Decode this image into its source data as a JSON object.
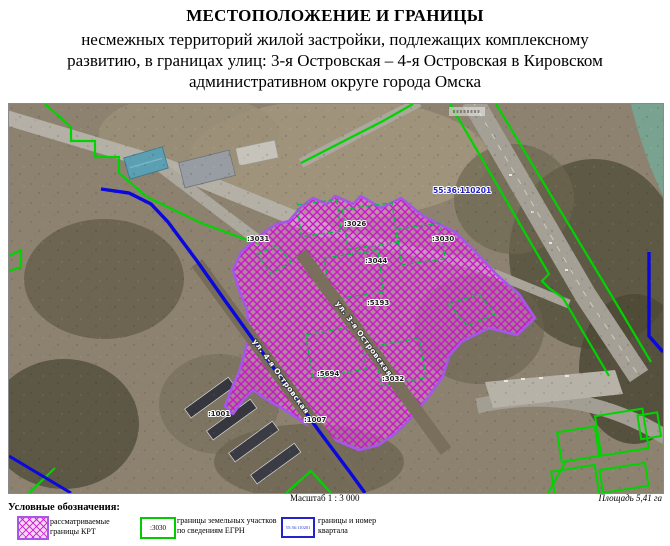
{
  "title": {
    "line1": "МЕСТОПОЛОЖЕНИЕ И ГРАНИЦЫ",
    "line2": "несмежных территорий жилой застройки, подлежащих комплексному",
    "line3": "развитию, в границах улиц: 3-я Островская – 4-я Островская в Кировском",
    "line4": "административном округе города Омска"
  },
  "map": {
    "quarter_number": "55:36:110201",
    "parcels": [
      {
        "id": ":3031"
      },
      {
        "id": ":3026"
      },
      {
        "id": ":3030"
      },
      {
        "id": ":3044"
      },
      {
        "id": ":5193"
      },
      {
        "id": ":5694"
      },
      {
        "id": ":3032"
      },
      {
        "id": ":1001"
      },
      {
        "id": ":1007"
      }
    ],
    "streets": [
      {
        "name": "ул. 3-я Островская"
      },
      {
        "name": "ул. 4-я Островская"
      }
    ],
    "colors": {
      "krt_border": "#a557e7",
      "krt_hatch": "#cc14cc",
      "egrn_green": "#00d400",
      "quarter_blue": "#0a08dc"
    }
  },
  "footer": {
    "scale": "Масштаб 1 : 3 000",
    "area": "Площадь 5,41 га"
  },
  "legend": {
    "title": "Условные обозначения:",
    "items": [
      {
        "label_line1": "рассматриваемые",
        "label_line2": "границы КРТ"
      },
      {
        "swatch_text": ":3030",
        "label_line1": "границы земельных участков",
        "label_line2": "по сведениям ЕГРН"
      },
      {
        "swatch_text": "55:36:110201",
        "label_line1": "границы и номер",
        "label_line2": "квартала"
      }
    ]
  }
}
